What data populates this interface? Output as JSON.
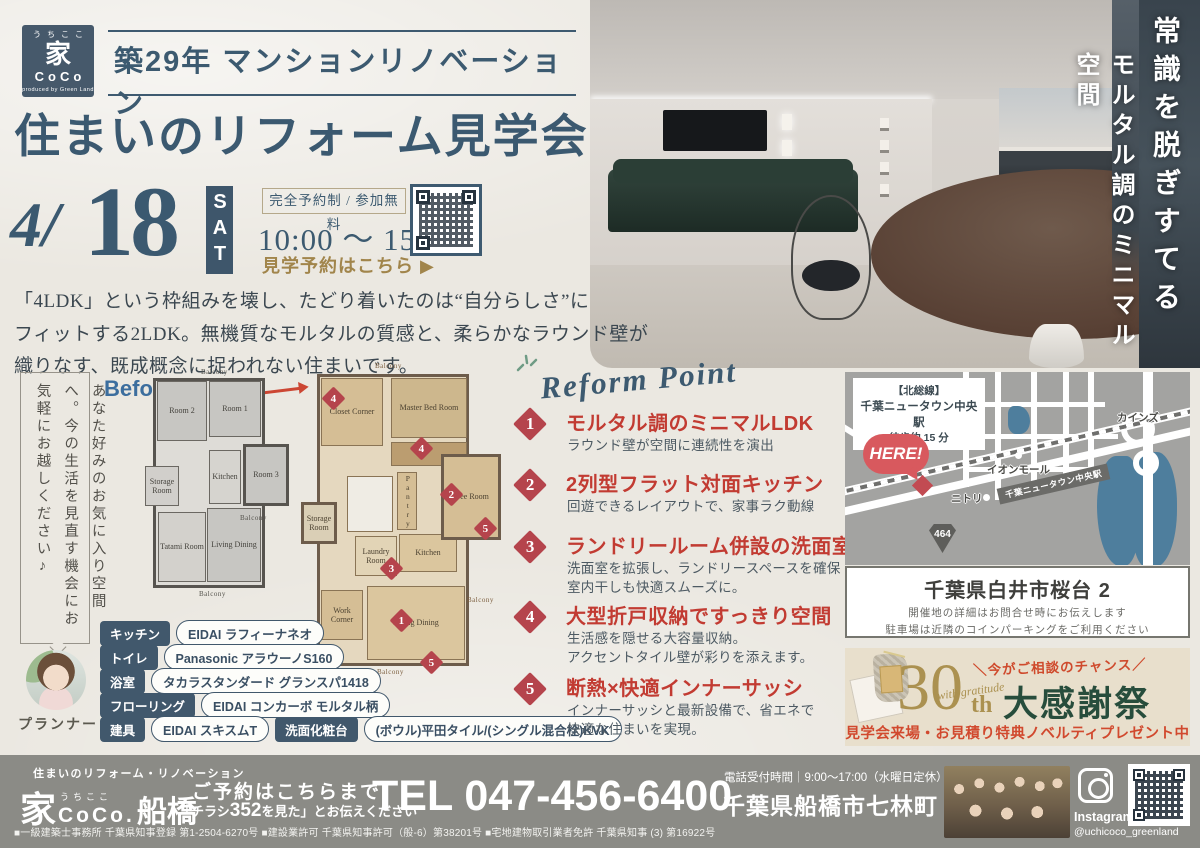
{
  "logo": {
    "furigana": "うちここ",
    "kanji": "家",
    "name": "CoCo",
    "byline": "produced by Green Land"
  },
  "header": {
    "title": "築29年 マンションリノベーション"
  },
  "event": {
    "title": "住まいのリフォーム見学会"
  },
  "date": {
    "month": "4/",
    "day": "18",
    "weekday": "SAT"
  },
  "booking": {
    "badge": "完全予約制 / 参加無料",
    "time": "10:00 〜 15:00",
    "cta": "見学予約はこちら ▶"
  },
  "intro": {
    "lines": [
      "「4LDK」という枠組みを壊し、たどり着いたのは“自分らしさ”に",
      "フィットする2LDK。無機質なモルタルの質感と、柔らかなラウンド壁が",
      "織りなす、既成概念に捉われない住まいです。"
    ]
  },
  "bubble": {
    "text": "あなた好みのお気に入り空間へ。今の生活を見直す機会にお気軽にお越しください♪",
    "role": "プランナー"
  },
  "photo": {
    "caption1": "常識を脱ぎすてる",
    "caption2": "モルタル調のミニマル空間"
  },
  "plans": {
    "markers": [
      "1",
      "2",
      "3",
      "4",
      "5"
    ],
    "before": {
      "label": "Before",
      "balcony": "Balcony",
      "rooms": {
        "room2": "Room 2",
        "room1": "Room 1",
        "room3": "Room 3",
        "storage": "Storage Room",
        "kitchen": "Kitchen",
        "tatami": "Tatami Room",
        "living": "Living Dining"
      }
    },
    "after": {
      "label": "After",
      "balcony": "Balcony",
      "rooms": {
        "closet": "Closet Corner",
        "master": "Master Bed Room",
        "pantry": "Pantry",
        "free": "Free Room",
        "storage": "Storage Room",
        "laundry": "Laundry Room",
        "kitchen": "Kitchen",
        "work": "Work Corner",
        "living": "Living Dining"
      }
    }
  },
  "specs": {
    "items": [
      {
        "label": "キッチン",
        "value": "EIDAI ラフィーナネオ"
      },
      {
        "label": "トイレ",
        "value": "Panasonic アラウーノS160"
      },
      {
        "label": "浴室",
        "value": "タカラスタンダード グランスパ1418"
      },
      {
        "label": "フローリング",
        "value": "EIDAI コンカーボ モルタル柄"
      },
      {
        "label": "建具",
        "value": "EIDAI スキスムT"
      },
      {
        "label": "洗面化粧台",
        "value": "(ボウル)平田タイル/(シングル混合栓)KVK"
      }
    ]
  },
  "reform": {
    "heading": "Reform Point",
    "points": [
      {
        "num": "1",
        "title": "モルタル調のミニマルLDK",
        "desc": [
          "ラウンド壁が空間に連続性を演出"
        ]
      },
      {
        "num": "2",
        "title": "2列型フラット対面キッチン",
        "desc": [
          "回遊できるレイアウトで、家事ラク動線"
        ]
      },
      {
        "num": "3",
        "title": "ランドリールーム併設の洗面室",
        "desc": [
          "洗面室を拡張し、ランドリースペースを確保",
          "室内干しも快適スムーズに。"
        ]
      },
      {
        "num": "4",
        "title": "大型折戸収納ですっきり空間",
        "desc": [
          "生活感を隠せる大容量収納。",
          "アクセントタイル壁が彩りを添えます。"
        ]
      },
      {
        "num": "5",
        "title": "断熱×快適インナーサッシ",
        "desc": [
          "インナーサッシと最新設備で、省エネで",
          "快適な住まいを実現。"
        ]
      }
    ]
  },
  "map": {
    "station_box": {
      "line1": "【北総線】",
      "line2": "千葉ニュータウン中央駅",
      "line3": "徒歩約 15 分"
    },
    "here": "HERE!",
    "labels": {
      "cainz": "カインズ",
      "aeon": "イオンモール",
      "nitori": "ニトリ",
      "station": "千葉ニュータウン中央駅",
      "route": "464"
    }
  },
  "venue": {
    "address": "千葉県白井市桜台 2",
    "note1": "開催地の詳細はお問合せ時にお伝えします",
    "note2": "駐車場は近隣のコインパーキングをご利用ください"
  },
  "anniversary": {
    "chance": "＼今がご相談のチャンス／",
    "num": "30",
    "th": "th",
    "script": "with gratitude",
    "title": "大感謝祭",
    "note": "見学会来場・お見積り特典ノベルティプレゼント中"
  },
  "footer": {
    "tagline": "住まいのリフォーム・リノベーション",
    "brand_kanji": "家",
    "brand_furigana": "うちここ",
    "brand_name": "CoCo.",
    "brand_branch": "船橋",
    "reserve1": "ご予約はこちらまで",
    "reserve2_pre": "「チラシ",
    "reserve2_num": "352",
    "reserve2_post": "を見た」とお伝えください",
    "tel": "TEL 047-456-6400",
    "hours": "電話受付時間｜9:00〜17:00（水曜日定休）",
    "address": "千葉県船橋市七林町 436",
    "instagram_label": "Instagram",
    "instagram_handle": "@uchicoco_greenland",
    "licenses": "■一級建築士事務所 千葉県知事登録 第1-2504-6270号 ■建設業許可 千葉県知事許可（般-6）第38201号 ■宅地建物取引業者免許 千葉県知事 (3) 第16922号"
  }
}
